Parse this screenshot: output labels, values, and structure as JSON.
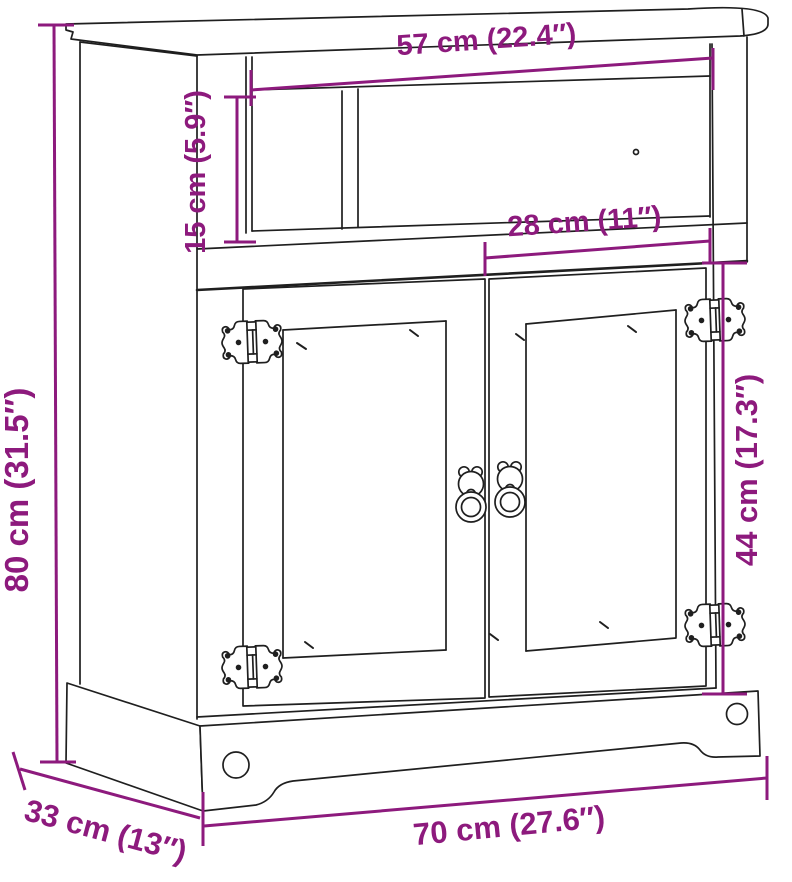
{
  "diagram": {
    "kind": "furniture-dimension-drawing",
    "subject": "two-door cabinet with open top shelf",
    "dims": {
      "niche_width": "57 cm (22.4″)",
      "niche_height": "15 cm (5.9″)",
      "door_width": "28 cm (11″)",
      "overall_height": "80 cm (31.5″)",
      "door_height": "44 cm (17.3″)",
      "overall_width": "70 cm (27.6″)",
      "overall_depth": "33 cm (13″)"
    },
    "colors": {
      "dimension_accent": "#8d1a7d",
      "outline": "#1f1f1f",
      "background": "#ffffff"
    },
    "icons": {
      "hinge": "butterfly-hinge",
      "handle": "ring-pull"
    }
  }
}
